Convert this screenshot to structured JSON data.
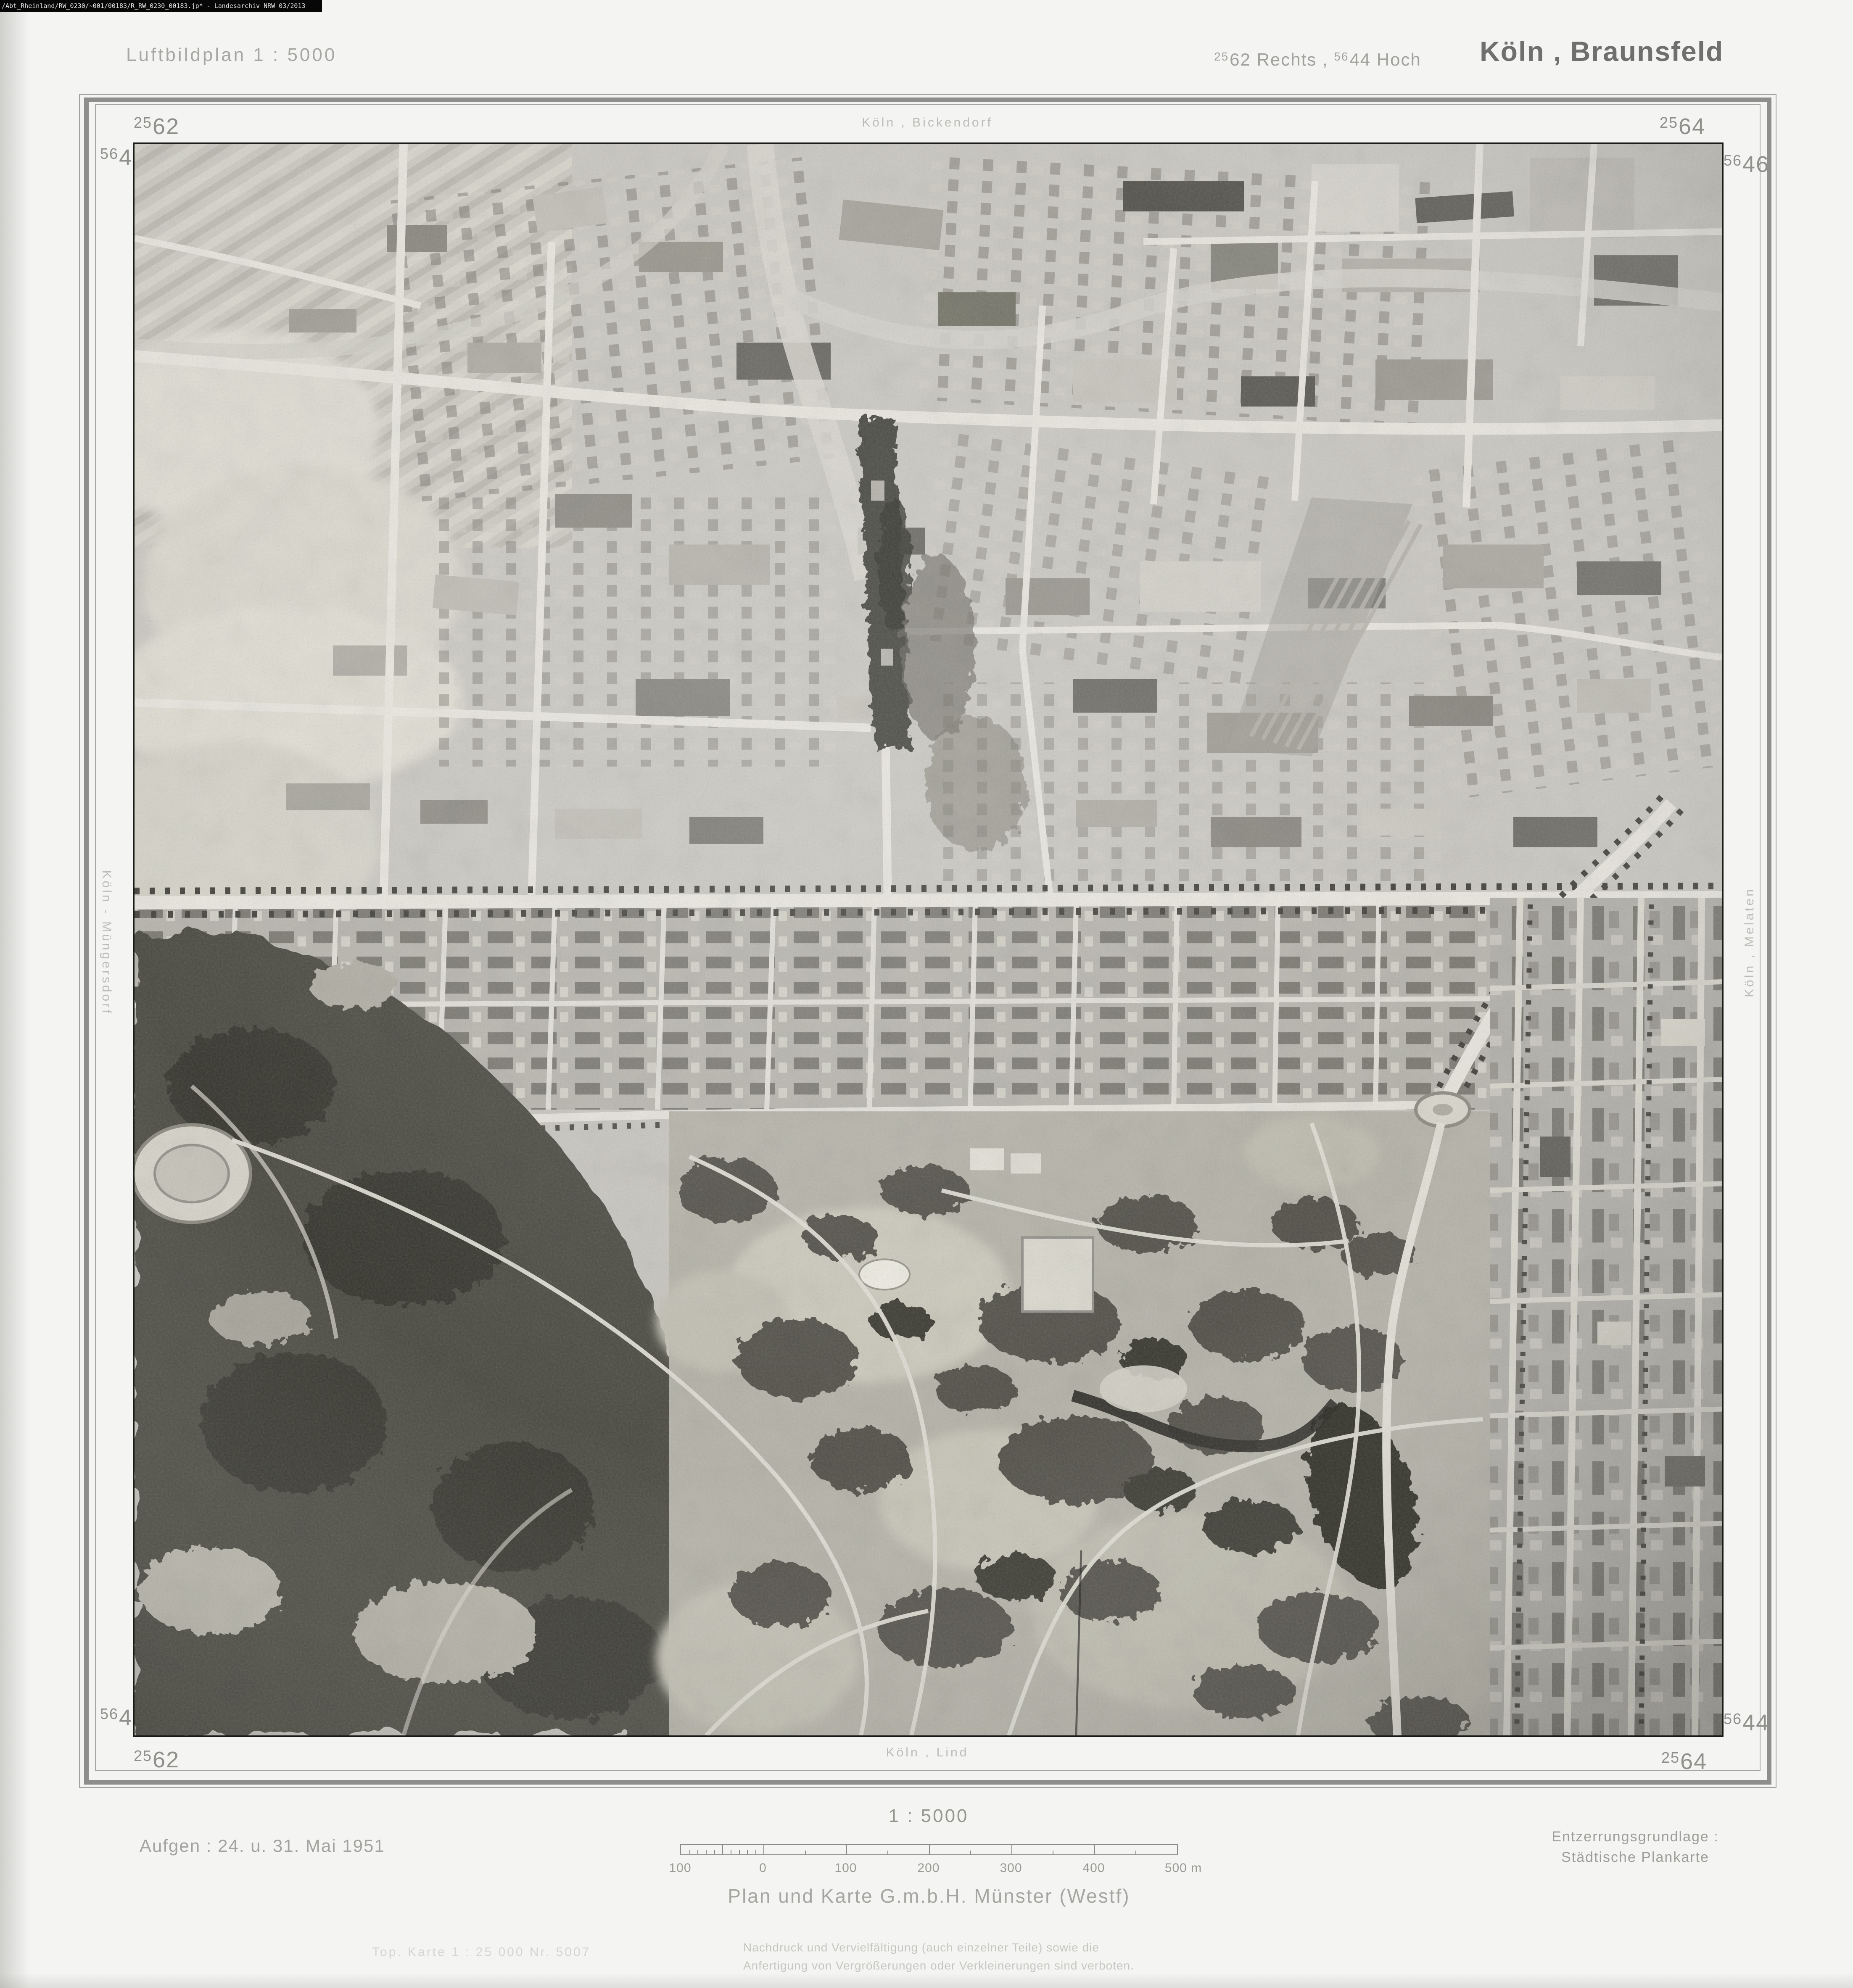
{
  "archive_bar": {
    "path_text": "/Abt_Rheinland/RW_0230/~001/00183/R_RW_0230_00183.jp* -  Landesarchiv NRW  03/2013"
  },
  "header": {
    "plan_title": "Luftbildplan  1 : 5000",
    "coords": {
      "sup1": "25",
      "main1": "62",
      "word1": "Rechts ,",
      "sup2": "56",
      "main2": "44",
      "word2": "Hoch"
    },
    "sheet_name": "Köln , Braunsfeld"
  },
  "map_frame": {
    "corner_labels": {
      "top_left_x": {
        "sup": "25",
        "main": "62"
      },
      "top_right_x": {
        "sup": "25",
        "main": "64"
      },
      "bottom_left_x": {
        "sup": "25",
        "main": "62"
      },
      "bottom_right_x": {
        "sup": "25",
        "main": "64"
      },
      "left_top_y": {
        "sup": "56",
        "main": "46"
      },
      "right_top_y": {
        "sup": "56",
        "main": "46"
      },
      "left_bottom_y": {
        "sup": "56",
        "main": "44"
      },
      "right_bottom_y": {
        "sup": "56",
        "main": "44"
      }
    },
    "edge_labels": {
      "top": "Köln , Bickendorf",
      "bottom": "Köln , Lind",
      "left": "Köln - Müngersdorf",
      "right": "Köln , Melaten"
    }
  },
  "footer": {
    "date_text": "Aufgen :  24. u. 31. Mai 1951",
    "scale_title": "1 : 5000",
    "scalebar": {
      "labels": [
        "100",
        "0",
        "100",
        "200",
        "300",
        "400",
        "500 m"
      ]
    },
    "basis_line1": "Entzerrungsgrundlage :",
    "basis_line2": "Städtische  Plankarte",
    "publisher": "Plan und Karte G.m.b.H.   Münster (Westf)",
    "topo_ref": "Top. Karte 1 : 25 000  Nr. 5007",
    "copyright_line1": "Nachdruck und Vervielfältigung (auch einzelner Teile) sowie die",
    "copyright_line2": "Anfertigung von Vergrößerungen oder Verkleinerungen sind verboten."
  },
  "colors": {
    "sheet_bg": "#f4f4f2",
    "frame_band": "#8e8e8c",
    "text_gray": "#9b9b98",
    "title_dark": "#6f6f6d",
    "photo_border": "#1a1a18",
    "photo_base": "#c8c6bf",
    "forest_dark": "#4c4b43"
  }
}
